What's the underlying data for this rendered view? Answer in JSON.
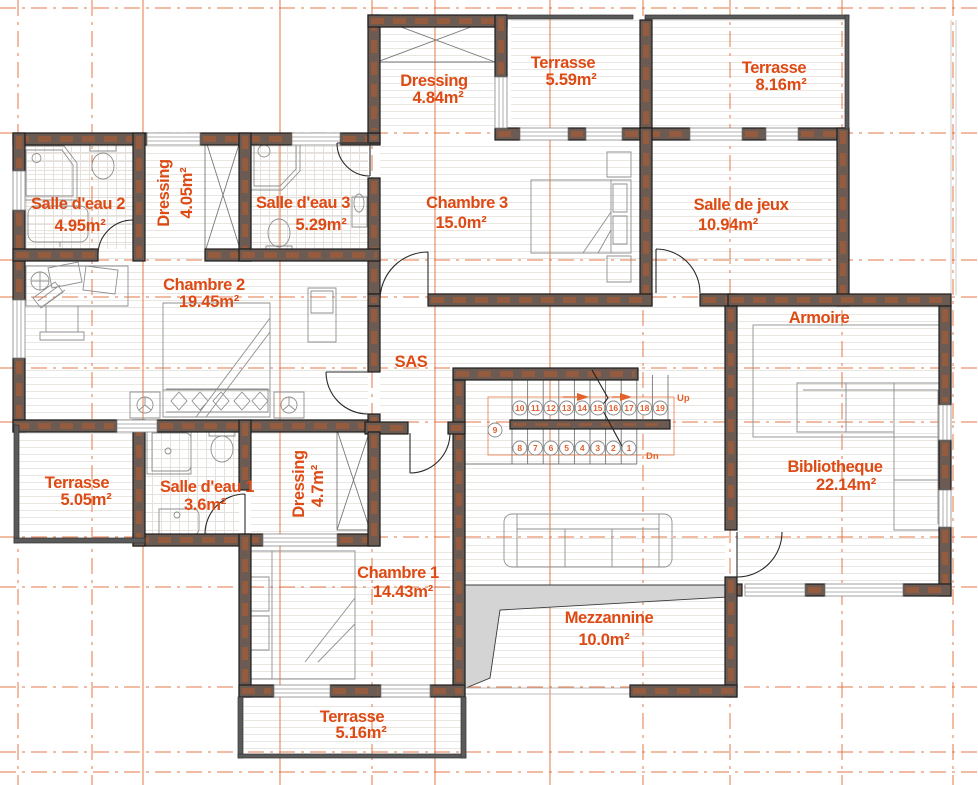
{
  "plan": {
    "colors": {
      "label_text": "#de4a14",
      "grid_line": "#e2622b",
      "wall_fill": "#6b5b53",
      "wall_core": "#9a5c3c",
      "wall_edge": "#1d1d1d",
      "mezzanine_shade": "#d4d4d4"
    },
    "rooms": [
      {
        "name": "Salle d'eau 2",
        "area": "4.95m²"
      },
      {
        "name": "Dressing",
        "area": "4.05m²"
      },
      {
        "name": "Salle d'eau 3",
        "area": "5.29m²"
      },
      {
        "name": "Chambre 2",
        "area": "19.45m²"
      },
      {
        "name": "Dressing",
        "area": "4.84m²"
      },
      {
        "name": "Terrasse",
        "area": "5.59m²"
      },
      {
        "name": "Terrasse",
        "area": "8.16m²"
      },
      {
        "name": "Chambre 3",
        "area": "15.0m²"
      },
      {
        "name": "Salle de jeux",
        "area": "10.94m²"
      },
      {
        "name": "SAS",
        "area": ""
      },
      {
        "name": "Armoire",
        "area": ""
      },
      {
        "name": "Bibliotheque",
        "area": "22.14m²"
      },
      {
        "name": "Terrasse",
        "area": "5.05m²"
      },
      {
        "name": "Salle d'eau 1",
        "area": "3.6m²"
      },
      {
        "name": "Dressing",
        "area": "4.7m²"
      },
      {
        "name": "Chambre 1",
        "area": "14.43m²"
      },
      {
        "name": "Mezzannine",
        "area": "10.0m²"
      },
      {
        "name": "Terrasse",
        "area": "5.16m²"
      }
    ],
    "stairs": {
      "up_label": "Up",
      "down_label": "Dn",
      "upper_steps": [
        "10",
        "11",
        "12",
        "13",
        "14",
        "15",
        "16",
        "17",
        "18",
        "19"
      ],
      "lower_steps": [
        "8",
        "7",
        "6",
        "5",
        "4",
        "3",
        "2",
        "1"
      ],
      "landing_step": "9"
    }
  }
}
